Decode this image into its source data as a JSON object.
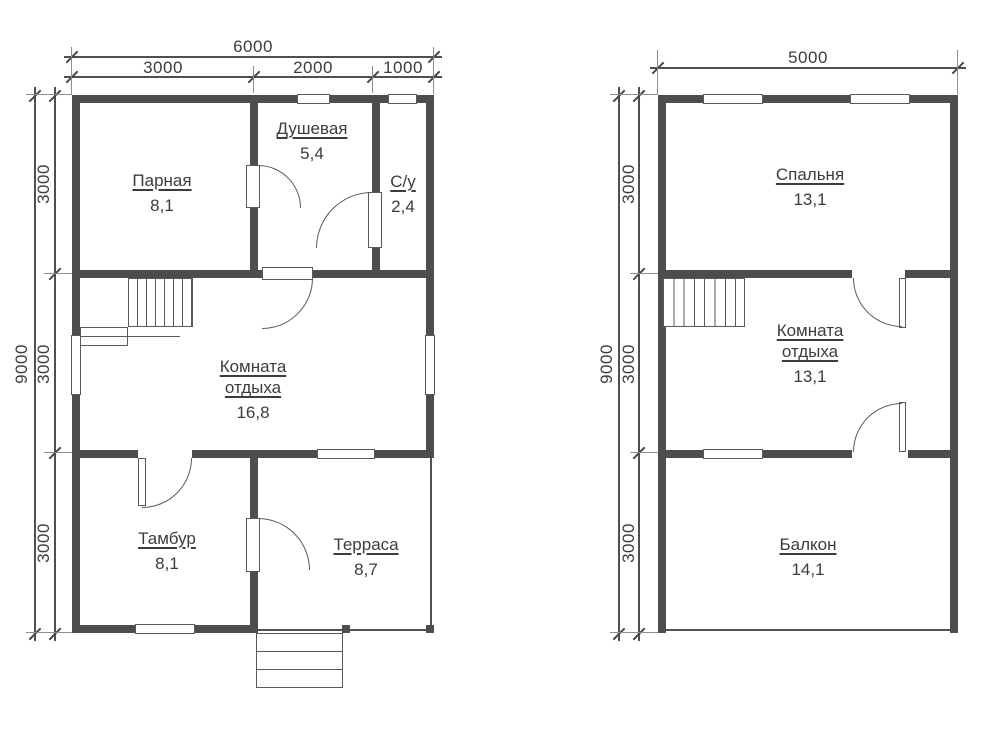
{
  "drawing": {
    "plans": {
      "left": {
        "dim_top_total": "6000",
        "dim_top_segments": [
          "3000",
          "2000",
          "1000"
        ],
        "dim_side_total": "9000",
        "dim_side_segments": [
          "3000",
          "3000",
          "3000"
        ],
        "rooms": {
          "parnaya": {
            "name": "Парная",
            "area": "8,1"
          },
          "dushevaya": {
            "name": "Душевая",
            "area": "5,4"
          },
          "su": {
            "name": "С/у",
            "area": "2,4"
          },
          "komnata_otdyha": {
            "name": "Комната отдыха",
            "area": "16,8"
          },
          "tambur": {
            "name": "Тамбур",
            "area": "8,1"
          },
          "terrasa": {
            "name": "Терраса",
            "area": "8,7"
          }
        }
      },
      "right": {
        "dim_top_total": "5000",
        "dim_side_total": "9000",
        "dim_side_segments": [
          "3000",
          "3000",
          "3000"
        ],
        "rooms": {
          "spalnya": {
            "name": "Спальня",
            "area": "13,1"
          },
          "komnata_otdyha": {
            "name": "Комната отдыха",
            "area": "13,1"
          },
          "balkon": {
            "name": "Балкон",
            "area": "14,1"
          }
        }
      }
    }
  }
}
